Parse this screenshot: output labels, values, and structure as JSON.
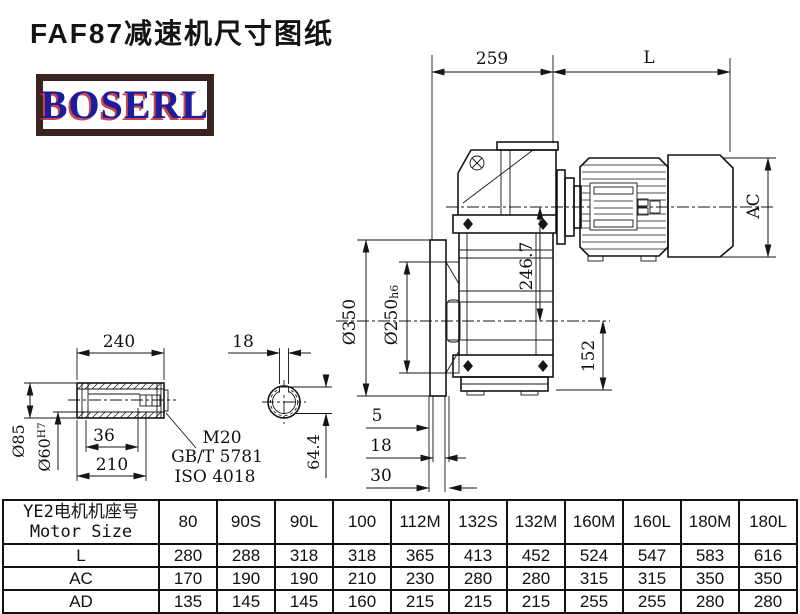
{
  "page": {
    "title": "FAF87减速机尺寸图纸",
    "logo": "BOSERL"
  },
  "drawing": {
    "dims": {
      "d259": "259",
      "dL": "L",
      "dAC": "AC",
      "d246_7": "246.7",
      "d350": "Ø350",
      "d250": "Ø250",
      "d250_tol": "h6",
      "d152": "152",
      "d5": "5",
      "d18_flange": "18",
      "d30": "30",
      "d240": "240",
      "d18_key": "18",
      "d85": "Ø85",
      "d60": "Ø60",
      "d60_tol": "H7",
      "d36": "36",
      "d210": "210",
      "d64_4": "64.4",
      "thread_label": "M20",
      "standard1": "GB/T 5781",
      "standard2": "ISO 4018"
    }
  },
  "table": {
    "header_cn": "YE2电机机座号",
    "header_en": "Motor Size",
    "columns": [
      "80",
      "90S",
      "90L",
      "100",
      "112M",
      "132S",
      "132M",
      "160M",
      "160L",
      "180M",
      "180L"
    ],
    "rows": [
      {
        "label": "L",
        "values": [
          "280",
          "288",
          "318",
          "318",
          "365",
          "413",
          "452",
          "524",
          "547",
          "583",
          "616"
        ]
      },
      {
        "label": "AC",
        "values": [
          "170",
          "190",
          "190",
          "210",
          "230",
          "280",
          "280",
          "315",
          "315",
          "350",
          "350"
        ]
      },
      {
        "label": "AD",
        "values": [
          "135",
          "145",
          "145",
          "160",
          "215",
          "215",
          "215",
          "255",
          "255",
          "280",
          "280"
        ]
      }
    ]
  },
  "colors": {
    "line": "#151515",
    "logo_blue": "#1c1c9e",
    "logo_shadow_red": "#c62222",
    "logo_border_brown": "#3a2420",
    "background": "#ffffff"
  }
}
